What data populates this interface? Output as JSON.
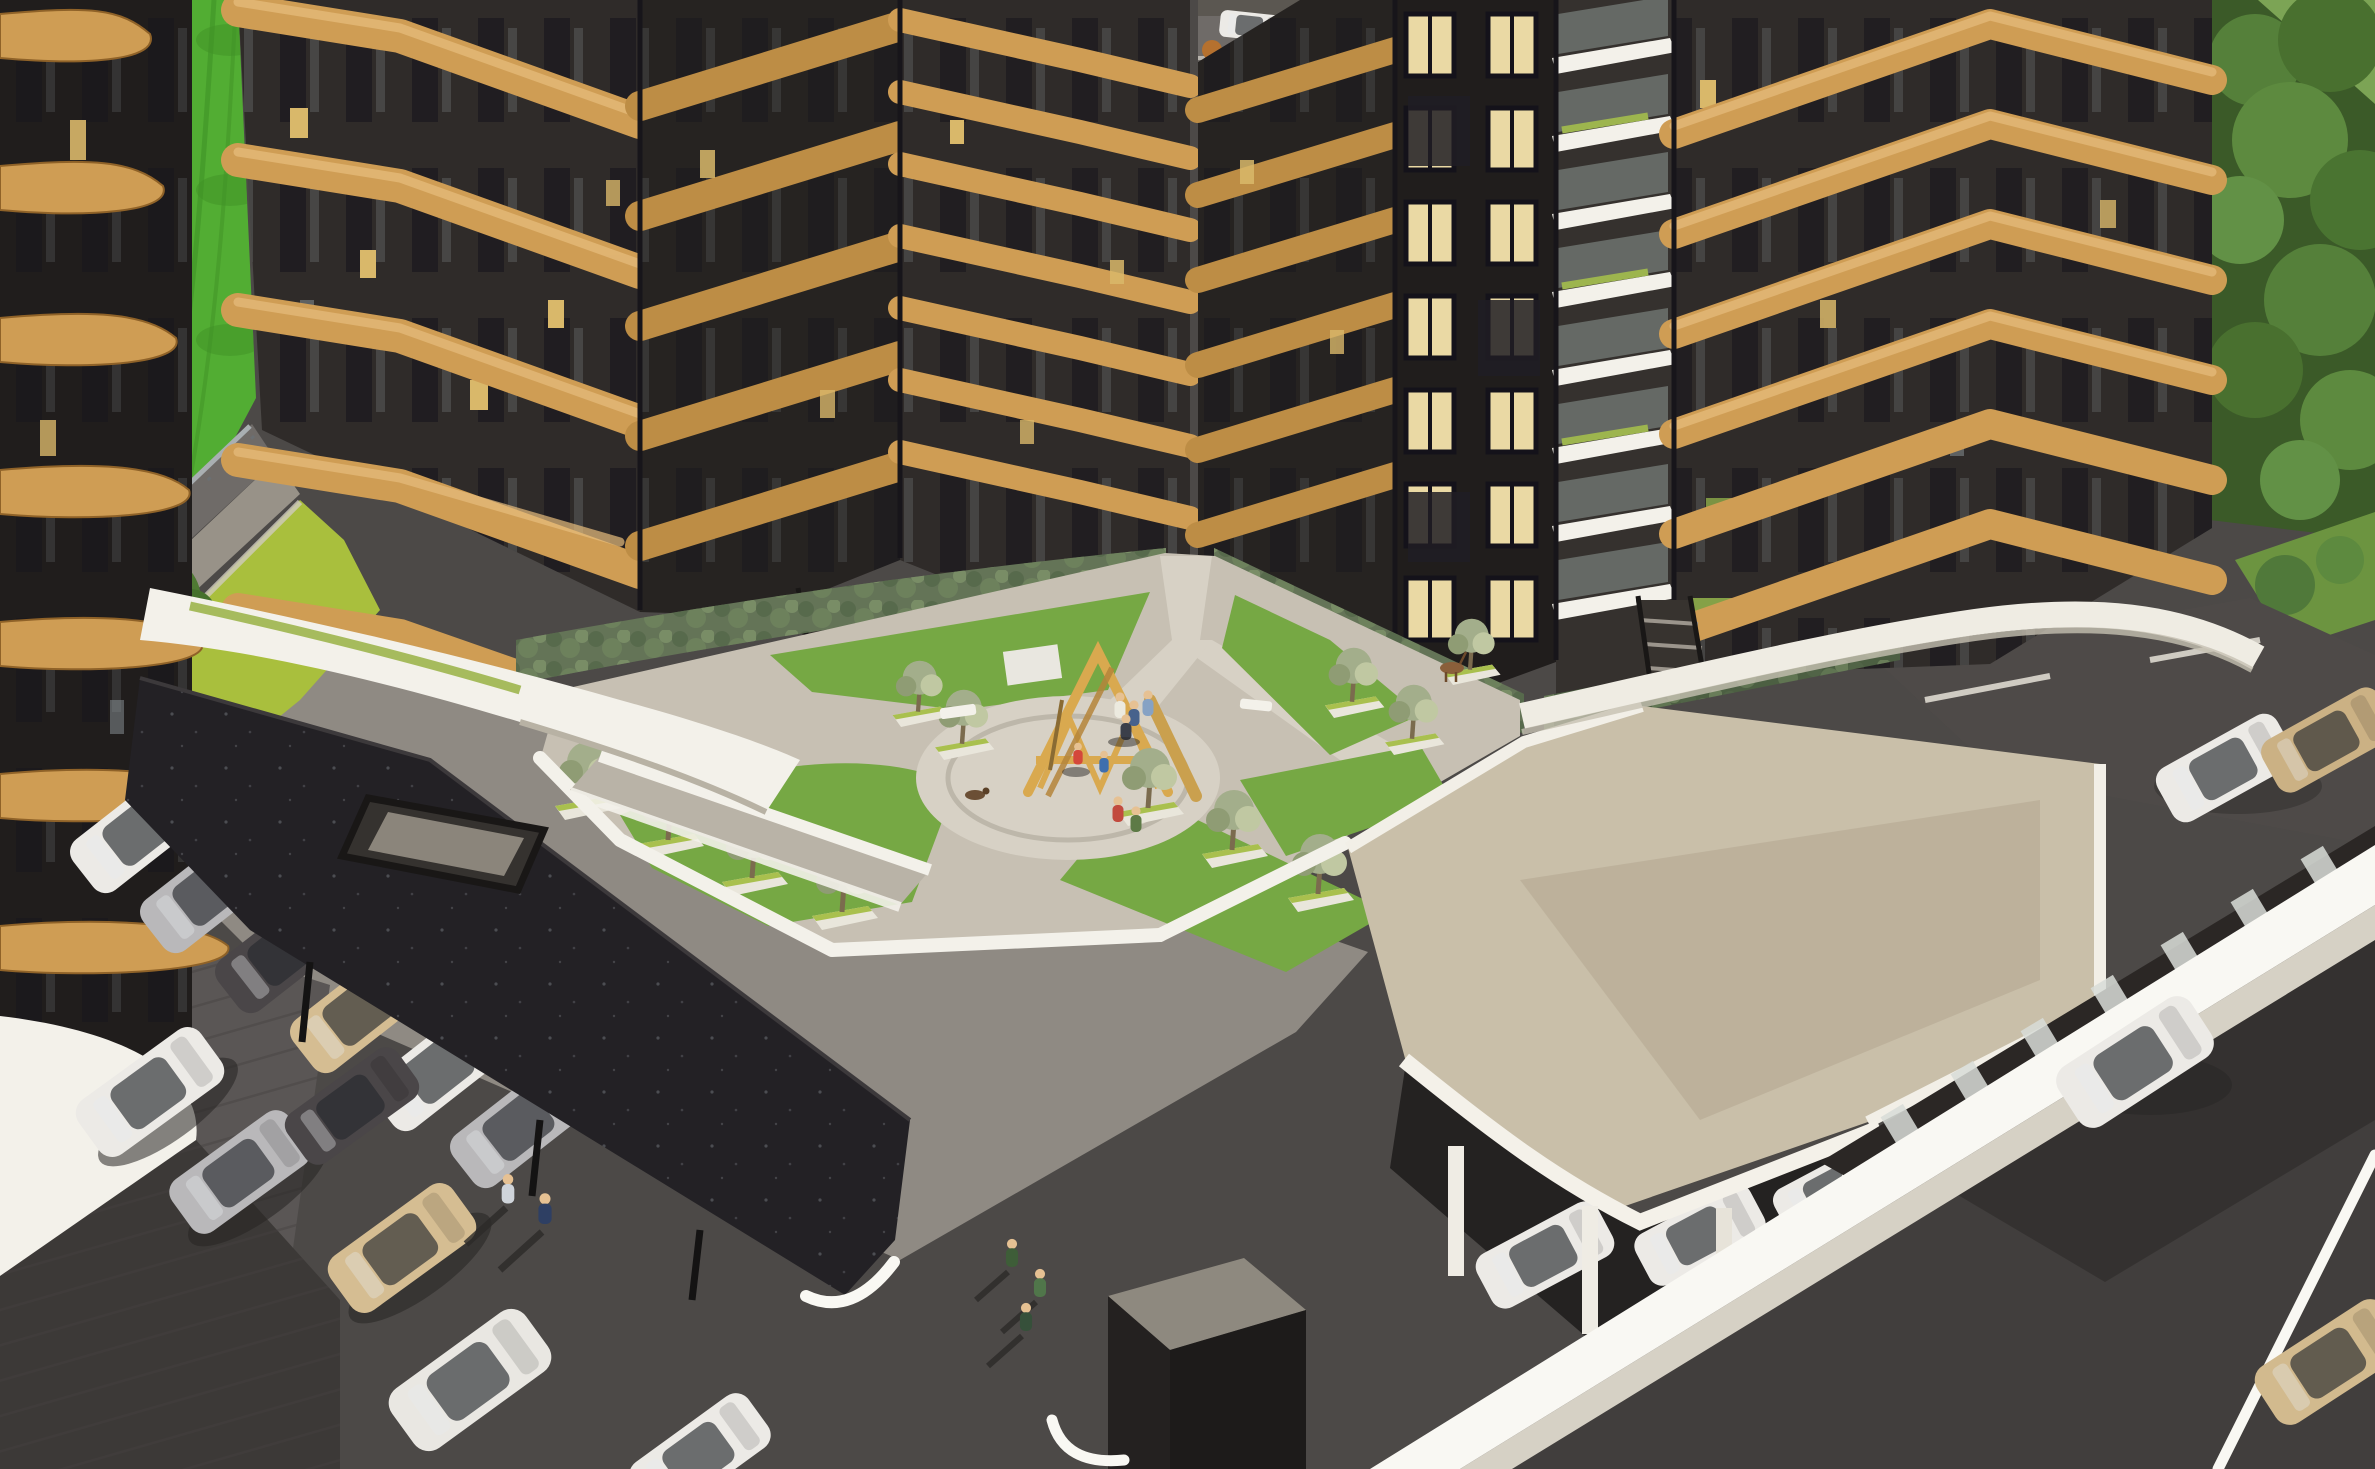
{
  "meta": {
    "kind": "architectural-3d-rendering",
    "view": "aerial-isometric",
    "time_of_day": "dusk",
    "visible_text": "none"
  },
  "palette": {
    "gold_light": "#e7bd7e",
    "gold": "#cf9d54",
    "gold_mid2": "#bd8d45",
    "gold_deep": "#8f6228",
    "facade": "#2f2b29",
    "facade_dark": "#201d1c",
    "facade_inner": "#262321",
    "win_dark": "#15141b",
    "win_glass": "#8d979c",
    "win_lit": "#ead9a4",
    "win_amber": "#d9b86a",
    "grass": "#52ad33",
    "grass_dark": "#3f9226",
    "grass_lime": "#a9bf3d",
    "lawn": "#76a844",
    "lawn_dark": "#5f8c33",
    "hedge": "#647457",
    "hedge_dark": "#4c5f42",
    "hedge_light": "#6e835d",
    "pave": "#c7c0b3",
    "pave_light": "#d7d1c5",
    "pave_grey": "#8f8a83",
    "white": "#f3f1ea",
    "white_bright": "#f9f8f3",
    "white_shade": "#d6d1c5",
    "beige": "#c9bfa9",
    "beige_dark": "#b2a68f",
    "canopy": "#232125",
    "asphalt": "#4c4947",
    "asphalt_light": "#5a5655",
    "asphalt_dark": "#3e3b3a",
    "shadow": "#2e2c2b",
    "car_white": "#eceae6",
    "car_silver": "#b9b8ba",
    "car_dark": "#4a4648",
    "car_beige": "#d5bd92",
    "wood": "#d9a94f",
    "wood_dark": "#b5853b",
    "forest": "#3b5a28",
    "forest_mid": "#55803a",
    "forest_light": "#6f9a48",
    "rail": "#a9afb2",
    "road_grey": "#6f6b68",
    "side_grey": "#989288"
  },
  "labels": {
    "scene": "Aerial dusk rendering of a residential complex with curved golden timber balcony bands around a landscaped courtyard",
    "field": "Bright green field strip along the upper left",
    "left_tower": "Foreground tower with wavy timber balcony ribbons on the left edge",
    "west_wing": "West wing tower with golden balcony bands",
    "north_towers": "North towers with golden balcony bands flanking the courtyard path",
    "lit_tower": "Back tower with warm lit window grid",
    "balcony_stack": "Stack of white slab balconies with planted terraces",
    "east_tower": "East corner tower with golden balcony bands",
    "forest": "Dense green forest backdrop at the top right",
    "courtyard": "Elevated podium courtyard with lawns, hedges and pergola trees",
    "playground": "Timber A-frame climbing structure on a paved circle",
    "dark_carport": "Long dark carport canopy with skylight hatch and parked cars",
    "white_carport": "White carport with columns sheltering white cars",
    "white_podium": "Curved white podium walls and walkway bands",
    "roads": "Dark asphalt roads with pedestrians and moving cars",
    "parking": "Surface parking areas with parked cars"
  },
  "scene": {
    "buildings": [
      {
        "id": "left-tower",
        "facade": "dark",
        "balconies": "wavy timber ribbons",
        "bands_visible": 7
      },
      {
        "id": "west-wing",
        "facade": "dark",
        "balconies": "golden bands",
        "bands_visible": 5
      },
      {
        "id": "north-tower-a",
        "facade": "dark",
        "balconies": "golden bands",
        "bands_visible": 5
      },
      {
        "id": "north-tower-b",
        "facade": "dark",
        "balconies": "golden bands",
        "bands_visible": 7
      },
      {
        "id": "north-tower-c",
        "facade": "dark",
        "balconies": "golden bands",
        "bands_visible": 6
      },
      {
        "id": "back-lit-tower",
        "facade": "dark",
        "windows": "warm lit grid",
        "rows_visible": 6
      },
      {
        "id": "balcony-stack",
        "facade": "white slabs",
        "levels_visible": 8
      },
      {
        "id": "east-tower",
        "facade": "dark",
        "balconies": "golden bands",
        "bands_visible": 6
      }
    ],
    "courtyard": {
      "lawns": 5,
      "hedge_walls": 3,
      "pergola_trees": 12,
      "planter_boxes": 12,
      "playground": "timber A-frame climber",
      "paved_circle": true,
      "benches": 2,
      "stairs": 2,
      "dog": true,
      "deer": true
    },
    "parking": {
      "dark_carport": {
        "cars_peeking": 6,
        "skylight_hatch": true,
        "posts": 3
      },
      "white_carport": {
        "columns": 4,
        "cars_visible": 3
      },
      "street_cluster_cars": 6,
      "upper_lot_cars": 2
    },
    "roads": {
      "left_road_guardrail": true,
      "right_road_median_curb": true,
      "moving_cars": 2,
      "entrance_kiosk_cube": true
    },
    "people": [
      {
        "where": "playground",
        "count": 4
      },
      {
        "where": "paved-circle",
        "count": 2
      },
      {
        "where": "courtyard-path",
        "count": 2
      },
      {
        "where": "street-left",
        "count": 2
      },
      {
        "where": "street-right",
        "count": 3
      }
    ],
    "vehicle_colors": [
      "white",
      "silver",
      "dark-grey",
      "beige"
    ]
  }
}
